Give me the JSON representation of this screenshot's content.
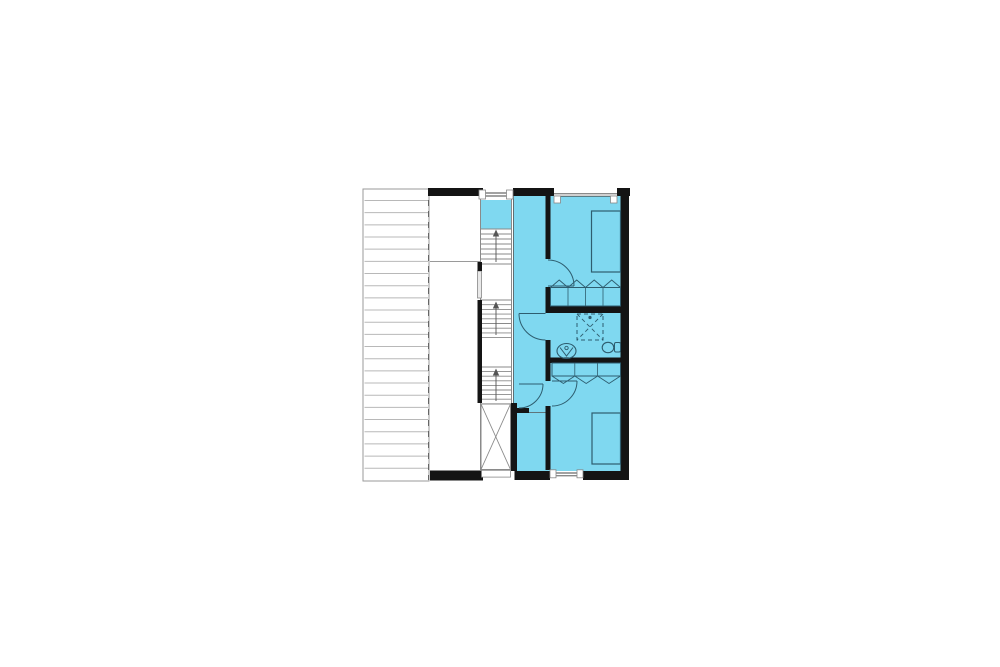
{
  "canvas": {
    "width": 1000,
    "height": 667,
    "background": "#ffffff"
  },
  "palette": {
    "CYAN": "#7fd8f0",
    "WALL": "#141414",
    "TEAL": "#2e5d6f",
    "GRAY": "#8a8a8a",
    "LIGHT": "#b8b8b8",
    "WHITE": "#ffffff"
  },
  "floor_plan": {
    "description": "upper-floor-plan",
    "highlighted_area_color": "#7fd8f0",
    "elements_depicted": [
      "roof-terrace-hatch",
      "stairwell-three-runs",
      "void-with-x-brace",
      "hallway",
      "bedroom-1",
      "bathroom",
      "bedroom-2",
      "storage-room",
      "beds",
      "closets-with-folding-doors",
      "shower",
      "washbasin",
      "toilet",
      "door-swings",
      "windows"
    ],
    "primitives": [
      {
        "t": "rect",
        "n": "terrace-area",
        "x": 363,
        "y": 189,
        "w": 66,
        "h": 292,
        "f": "WHITE",
        "s": "#9a9a9a",
        "sw": 1
      },
      {
        "t": "hlines",
        "n": "terrace-hatch",
        "x1": 364.5,
        "x2": 428,
        "y": 200.5,
        "step": 12.17,
        "count": 23,
        "s": "LIGHT",
        "sw": 1
      },
      {
        "t": "line",
        "n": "terrace-edge-dashed",
        "x1": 428.5,
        "y1": 189,
        "x2": 428.5,
        "y2": 480,
        "s": "#666666",
        "sw": 1,
        "da": "6 5"
      },
      {
        "t": "line",
        "n": "middle-room-divider",
        "x1": 430,
        "y1": 261.5,
        "x2": 480,
        "y2": 261.5,
        "s": "#9a9a9a",
        "sw": 1
      },
      {
        "t": "rect",
        "n": "apartment-floor",
        "x": 513,
        "y": 196,
        "w": 108,
        "h": 275,
        "f": "CYAN"
      },
      {
        "t": "rect",
        "n": "stair-landing-floor",
        "x": 481,
        "y": 200,
        "w": 31,
        "h": 29,
        "f": "CYAN"
      },
      {
        "t": "line",
        "n": "stair-left-border",
        "x1": 480.5,
        "y1": 196,
        "x2": 480.5,
        "y2": 470,
        "s": "GRAY",
        "sw": 1
      },
      {
        "t": "line",
        "n": "stair-right-border",
        "x1": 511.5,
        "y1": 196,
        "x2": 511.5,
        "y2": 404,
        "s": "GRAY",
        "sw": 1
      },
      {
        "t": "line",
        "n": "hallway-left-border",
        "x1": 513.4,
        "y1": 196,
        "x2": 513.4,
        "y2": 403,
        "s": "#555555",
        "sw": 0.8
      },
      {
        "t": "hlines",
        "n": "stair-run-1",
        "x1": 481,
        "x2": 511.5,
        "y": 229,
        "step": 5,
        "count": 8,
        "s": "GRAY",
        "sw": 0.9
      },
      {
        "t": "hlines",
        "n": "stair-run-2",
        "x1": 481,
        "x2": 511.5,
        "y": 300,
        "step": 4.7,
        "count": 9,
        "s": "GRAY",
        "sw": 0.9
      },
      {
        "t": "hlines",
        "n": "stair-run-3",
        "x1": 481,
        "x2": 511.5,
        "y": 367,
        "step": 4.6,
        "count": 9,
        "s": "GRAY",
        "sw": 0.9
      },
      {
        "t": "path",
        "n": "stair-arrow-1-stem",
        "d": "M496,262 L496,233",
        "s": "#555555",
        "sw": 0.9
      },
      {
        "t": "path",
        "n": "stair-arrow-1-head",
        "d": "M492.8,236.5 L496,229.5 L499.2,236.5 Z",
        "f": "#555555"
      },
      {
        "t": "path",
        "n": "stair-arrow-2-stem",
        "d": "M496,335 L496,305",
        "s": "#555555",
        "sw": 0.9
      },
      {
        "t": "path",
        "n": "stair-arrow-2-head",
        "d": "M492.8,308.5 L496,301.5 L499.2,308.5 Z",
        "f": "#555555"
      },
      {
        "t": "path",
        "n": "stair-arrow-3-stem",
        "d": "M496,401 L496,372",
        "s": "#555555",
        "sw": 0.9
      },
      {
        "t": "path",
        "n": "stair-arrow-3-head",
        "d": "M492.8,375.5 L496,368.5 L499.2,375.5 Z",
        "f": "#555555"
      },
      {
        "t": "rect",
        "n": "void-shaft",
        "x": 481,
        "y": 404,
        "w": 29.5,
        "h": 65.5,
        "f": "WHITE",
        "s": "GRAY",
        "sw": 1
      },
      {
        "t": "line",
        "n": "void-diagonal-1",
        "x1": 481,
        "y1": 404,
        "x2": 510.5,
        "y2": 469.5,
        "s": "GRAY",
        "sw": 0.9
      },
      {
        "t": "line",
        "n": "void-diagonal-2",
        "x1": 510.5,
        "y1": 404,
        "x2": 481,
        "y2": 469.5,
        "s": "GRAY",
        "sw": 0.9
      },
      {
        "t": "rect",
        "n": "stairwell-window",
        "x": 477.5,
        "y": 271,
        "w": 4,
        "h": 27,
        "f": "#e9e9e9",
        "s": "#888888",
        "sw": 0.8
      },
      {
        "t": "rect",
        "n": "wall-top-a",
        "x": 428,
        "y": 188,
        "w": 55,
        "h": 8,
        "f": "WALL"
      },
      {
        "t": "rect",
        "n": "wall-top-b",
        "x": 513,
        "y": 188,
        "w": 41,
        "h": 8,
        "f": "WALL"
      },
      {
        "t": "rect",
        "n": "wall-top-c",
        "x": 617,
        "y": 188,
        "w": 13,
        "h": 8,
        "f": "WALL"
      },
      {
        "t": "rect",
        "n": "wall-right",
        "x": 620.5,
        "y": 188,
        "w": 8.5,
        "h": 291,
        "f": "WALL"
      },
      {
        "t": "rect",
        "n": "wall-stair-stub",
        "x": 477.5,
        "y": 262,
        "w": 4.5,
        "h": 9,
        "f": "WALL"
      },
      {
        "t": "rect",
        "n": "wall-stairwell",
        "x": 477.5,
        "y": 300,
        "w": 4.5,
        "h": 103,
        "f": "WALL"
      },
      {
        "t": "rect",
        "n": "wall-hall-1",
        "x": 545.5,
        "y": 196,
        "w": 5,
        "h": 63,
        "f": "WALL"
      },
      {
        "t": "rect",
        "n": "wall-hall-2",
        "x": 545.5,
        "y": 287,
        "w": 5,
        "h": 26,
        "f": "WALL"
      },
      {
        "t": "rect",
        "n": "wall-hall-3",
        "x": 545.5,
        "y": 340,
        "w": 5,
        "h": 41,
        "f": "WALL"
      },
      {
        "t": "rect",
        "n": "wall-hall-4",
        "x": 545.5,
        "y": 406,
        "w": 5,
        "h": 64,
        "f": "WALL"
      },
      {
        "t": "rect",
        "n": "wall-bath-top",
        "x": 545.5,
        "y": 306,
        "w": 75,
        "h": 7,
        "f": "WALL"
      },
      {
        "t": "rect",
        "n": "wall-bath-bottom",
        "x": 550,
        "y": 357.5,
        "w": 70.5,
        "h": 5.5,
        "f": "WALL"
      },
      {
        "t": "rect",
        "n": "wall-store-left",
        "x": 511,
        "y": 403,
        "w": 6,
        "h": 68,
        "f": "WALL"
      },
      {
        "t": "rect",
        "n": "wall-store-stub",
        "x": 517,
        "y": 408,
        "w": 12,
        "h": 5,
        "f": "WALL"
      },
      {
        "t": "line",
        "n": "store-threshold",
        "x1": 529,
        "y1": 412.5,
        "x2": 545.5,
        "y2": 412.5,
        "s": "#555555",
        "sw": 0.8
      },
      {
        "t": "rect",
        "n": "wall-bottom-a",
        "x": 430,
        "y": 470.5,
        "w": 53,
        "h": 10,
        "f": "WALL"
      },
      {
        "t": "rect",
        "n": "wall-bottom-b",
        "x": 514.5,
        "y": 471,
        "w": 35.5,
        "h": 9,
        "f": "WALL"
      },
      {
        "t": "rect",
        "n": "wall-bottom-c",
        "x": 583,
        "y": 471,
        "w": 46,
        "h": 9,
        "f": "WALL"
      },
      {
        "t": "line",
        "n": "window-stair-glass-1",
        "x1": 482,
        "y1": 193,
        "x2": 511,
        "y2": 193,
        "s": "#444444",
        "sw": 0.9
      },
      {
        "t": "line",
        "n": "window-stair-glass-2",
        "x1": 482,
        "y1": 196,
        "x2": 511,
        "y2": 196,
        "s": "#444444",
        "sw": 0.9
      },
      {
        "t": "rect",
        "n": "window-stair-jamb-1",
        "x": 479,
        "y": 190,
        "w": 6.5,
        "h": 9,
        "f": "WHITE",
        "s": "#888888",
        "sw": 0.8
      },
      {
        "t": "rect",
        "n": "window-stair-jamb-2",
        "x": 506.5,
        "y": 190,
        "w": 6.5,
        "h": 9,
        "f": "WHITE",
        "s": "#888888",
        "sw": 0.8
      },
      {
        "t": "line",
        "n": "window-bed1-glass-1",
        "x1": 554,
        "y1": 193.8,
        "x2": 617,
        "y2": 193.8,
        "s": "#444444",
        "sw": 0.9
      },
      {
        "t": "line",
        "n": "window-bed1-glass-2",
        "x1": 554,
        "y1": 196.2,
        "x2": 617,
        "y2": 196.2,
        "s": "#444444",
        "sw": 0.9
      },
      {
        "t": "rect",
        "n": "window-bed1-jamb-1",
        "x": 554,
        "y": 196,
        "w": 6.5,
        "h": 7,
        "f": "WHITE",
        "s": "#888888",
        "sw": 0.8
      },
      {
        "t": "rect",
        "n": "window-bed1-jamb-2",
        "x": 610.5,
        "y": 196,
        "w": 6.5,
        "h": 7,
        "f": "WHITE",
        "s": "#888888",
        "sw": 0.8
      },
      {
        "t": "line",
        "n": "window-bed2-glass-1",
        "x1": 550,
        "y1": 473,
        "x2": 583,
        "y2": 473,
        "s": "#444444",
        "sw": 0.9
      },
      {
        "t": "line",
        "n": "window-bed2-glass-2",
        "x1": 550,
        "y1": 475.8,
        "x2": 583,
        "y2": 475.8,
        "s": "#444444",
        "sw": 0.9
      },
      {
        "t": "rect",
        "n": "window-bed2-jamb-1",
        "x": 550,
        "y": 469.8,
        "w": 6,
        "h": 8,
        "f": "WHITE",
        "s": "#888888",
        "sw": 0.8
      },
      {
        "t": "rect",
        "n": "window-bed2-jamb-2",
        "x": 577,
        "y": 469.8,
        "w": 6,
        "h": 8,
        "f": "WHITE",
        "s": "#888888",
        "sw": 0.8
      },
      {
        "t": "rect",
        "n": "window-void-bottom",
        "x": 481.5,
        "y": 470.3,
        "w": 29,
        "h": 6.8,
        "f": "WHITE",
        "s": "#888888",
        "sw": 0.8
      },
      {
        "t": "rect",
        "n": "bed-1",
        "x": 591.5,
        "y": 211,
        "w": 29,
        "h": 61,
        "s": "TEAL",
        "sw": 1.2
      },
      {
        "t": "rect",
        "n": "bed-2",
        "x": 592,
        "y": 413,
        "w": 28.5,
        "h": 51,
        "s": "TEAL",
        "sw": 1.2
      },
      {
        "t": "rect",
        "n": "closet-1-box",
        "x": 550.5,
        "y": 287.5,
        "w": 70,
        "h": 18.5,
        "s": "TEAL",
        "sw": 1
      },
      {
        "t": "line",
        "n": "closet-1-div-1",
        "x1": 568,
        "y1": 287.5,
        "x2": 568,
        "y2": 306,
        "s": "TEAL",
        "sw": 0.8
      },
      {
        "t": "line",
        "n": "closet-1-div-2",
        "x1": 585.5,
        "y1": 287.5,
        "x2": 585.5,
        "y2": 306,
        "s": "TEAL",
        "sw": 0.8
      },
      {
        "t": "line",
        "n": "closet-1-div-3",
        "x1": 603,
        "y1": 287.5,
        "x2": 603,
        "y2": 306,
        "s": "TEAL",
        "sw": 0.8
      },
      {
        "t": "path",
        "n": "closet-1-doors",
        "d": "M550.5,287.5 L559.2,280 L568,287.5 L576.7,280 L585.5,287.5 L594.2,280 L603,287.5 L611.7,280 L620.5,287.5",
        "s": "TEAL",
        "sw": 0.9
      },
      {
        "t": "rect",
        "n": "closet-2-box",
        "x": 552,
        "y": 363,
        "w": 68.5,
        "h": 13,
        "s": "TEAL",
        "sw": 1
      },
      {
        "t": "line",
        "n": "closet-2-div-1",
        "x1": 574.8,
        "y1": 363,
        "x2": 574.8,
        "y2": 376,
        "s": "TEAL",
        "sw": 0.8
      },
      {
        "t": "line",
        "n": "closet-2-div-2",
        "x1": 597.6,
        "y1": 363,
        "x2": 597.6,
        "y2": 376,
        "s": "TEAL",
        "sw": 0.8
      },
      {
        "t": "path",
        "n": "closet-2-doors",
        "d": "M552,376 L563.4,383.5 L574.8,376 L586.2,383.5 L597.6,376 L609,383.5 L620.5,376",
        "s": "TEAL",
        "sw": 0.9
      },
      {
        "t": "rect",
        "n": "shower",
        "x": 577,
        "y": 314,
        "w": 26,
        "h": 26,
        "s": "TEAL",
        "sw": 1,
        "da": "4 3"
      },
      {
        "t": "line",
        "n": "shower-x-1",
        "x1": 577,
        "y1": 314,
        "x2": 603,
        "y2": 340,
        "s": "TEAL",
        "sw": 0.9,
        "da": "4 3"
      },
      {
        "t": "line",
        "n": "shower-x-2",
        "x1": 603,
        "y1": 314,
        "x2": 577,
        "y2": 340,
        "s": "TEAL",
        "sw": 0.9,
        "da": "4 3"
      },
      {
        "t": "circle",
        "n": "shower-drain",
        "cx": 590,
        "cy": 317.5,
        "r": 1.6,
        "f": "TEAL"
      },
      {
        "t": "ellipse",
        "n": "sink-basin",
        "cx": 566.5,
        "cy": 351,
        "rx": 9.5,
        "ry": 7.5,
        "s": "TEAL",
        "sw": 1.1
      },
      {
        "t": "path",
        "n": "sink-tap",
        "d": "M560,347.5 L566.5,356 L573,347.5",
        "s": "TEAL",
        "sw": 1
      },
      {
        "t": "circle",
        "n": "sink-faucet",
        "cx": 566.5,
        "cy": 348,
        "r": 1.7,
        "s": "TEAL",
        "sw": 0.9
      },
      {
        "t": "ellipse",
        "n": "toilet-bowl",
        "cx": 608,
        "cy": 347.5,
        "rx": 5.8,
        "ry": 5.2,
        "s": "TEAL",
        "sw": 1.1
      },
      {
        "t": "rect",
        "n": "toilet-tank",
        "x": 614.5,
        "y": 342.5,
        "w": 6,
        "h": 9.5,
        "rx": 1.5,
        "s": "TEAL",
        "sw": 1
      },
      {
        "t": "line",
        "n": "door-bed1-leaf",
        "x1": 548,
        "y1": 286,
        "x2": 574,
        "y2": 286,
        "s": "TEAL",
        "sw": 1.1
      },
      {
        "t": "path",
        "n": "door-bed1-swing",
        "d": "M548,260 A26,26 0 0 1 574,286",
        "s": "TEAL",
        "sw": 1
      },
      {
        "t": "line",
        "n": "door-bath-leaf",
        "x1": 519,
        "y1": 313.5,
        "x2": 545.5,
        "y2": 313.5,
        "s": "TEAL",
        "sw": 1.1
      },
      {
        "t": "path",
        "n": "door-bath-swing",
        "d": "M519,313.5 A26.5,26.5 0 0 0 545.5,340",
        "s": "TEAL",
        "sw": 1
      },
      {
        "t": "line",
        "n": "door-bed2-leaf",
        "x1": 552,
        "y1": 381,
        "x2": 577,
        "y2": 381,
        "s": "TEAL",
        "sw": 1.1
      },
      {
        "t": "path",
        "n": "door-bed2-swing",
        "d": "M577,381 A25,25 0 0 1 552,406",
        "s": "TEAL",
        "sw": 1
      },
      {
        "t": "line",
        "n": "door-entry-leaf",
        "x1": 519,
        "y1": 384,
        "x2": 543,
        "y2": 384,
        "s": "TEAL",
        "sw": 1.1
      },
      {
        "t": "path",
        "n": "door-entry-swing",
        "d": "M543,384 A24,24 0 0 1 519,408",
        "s": "TEAL",
        "sw": 1
      }
    ]
  }
}
